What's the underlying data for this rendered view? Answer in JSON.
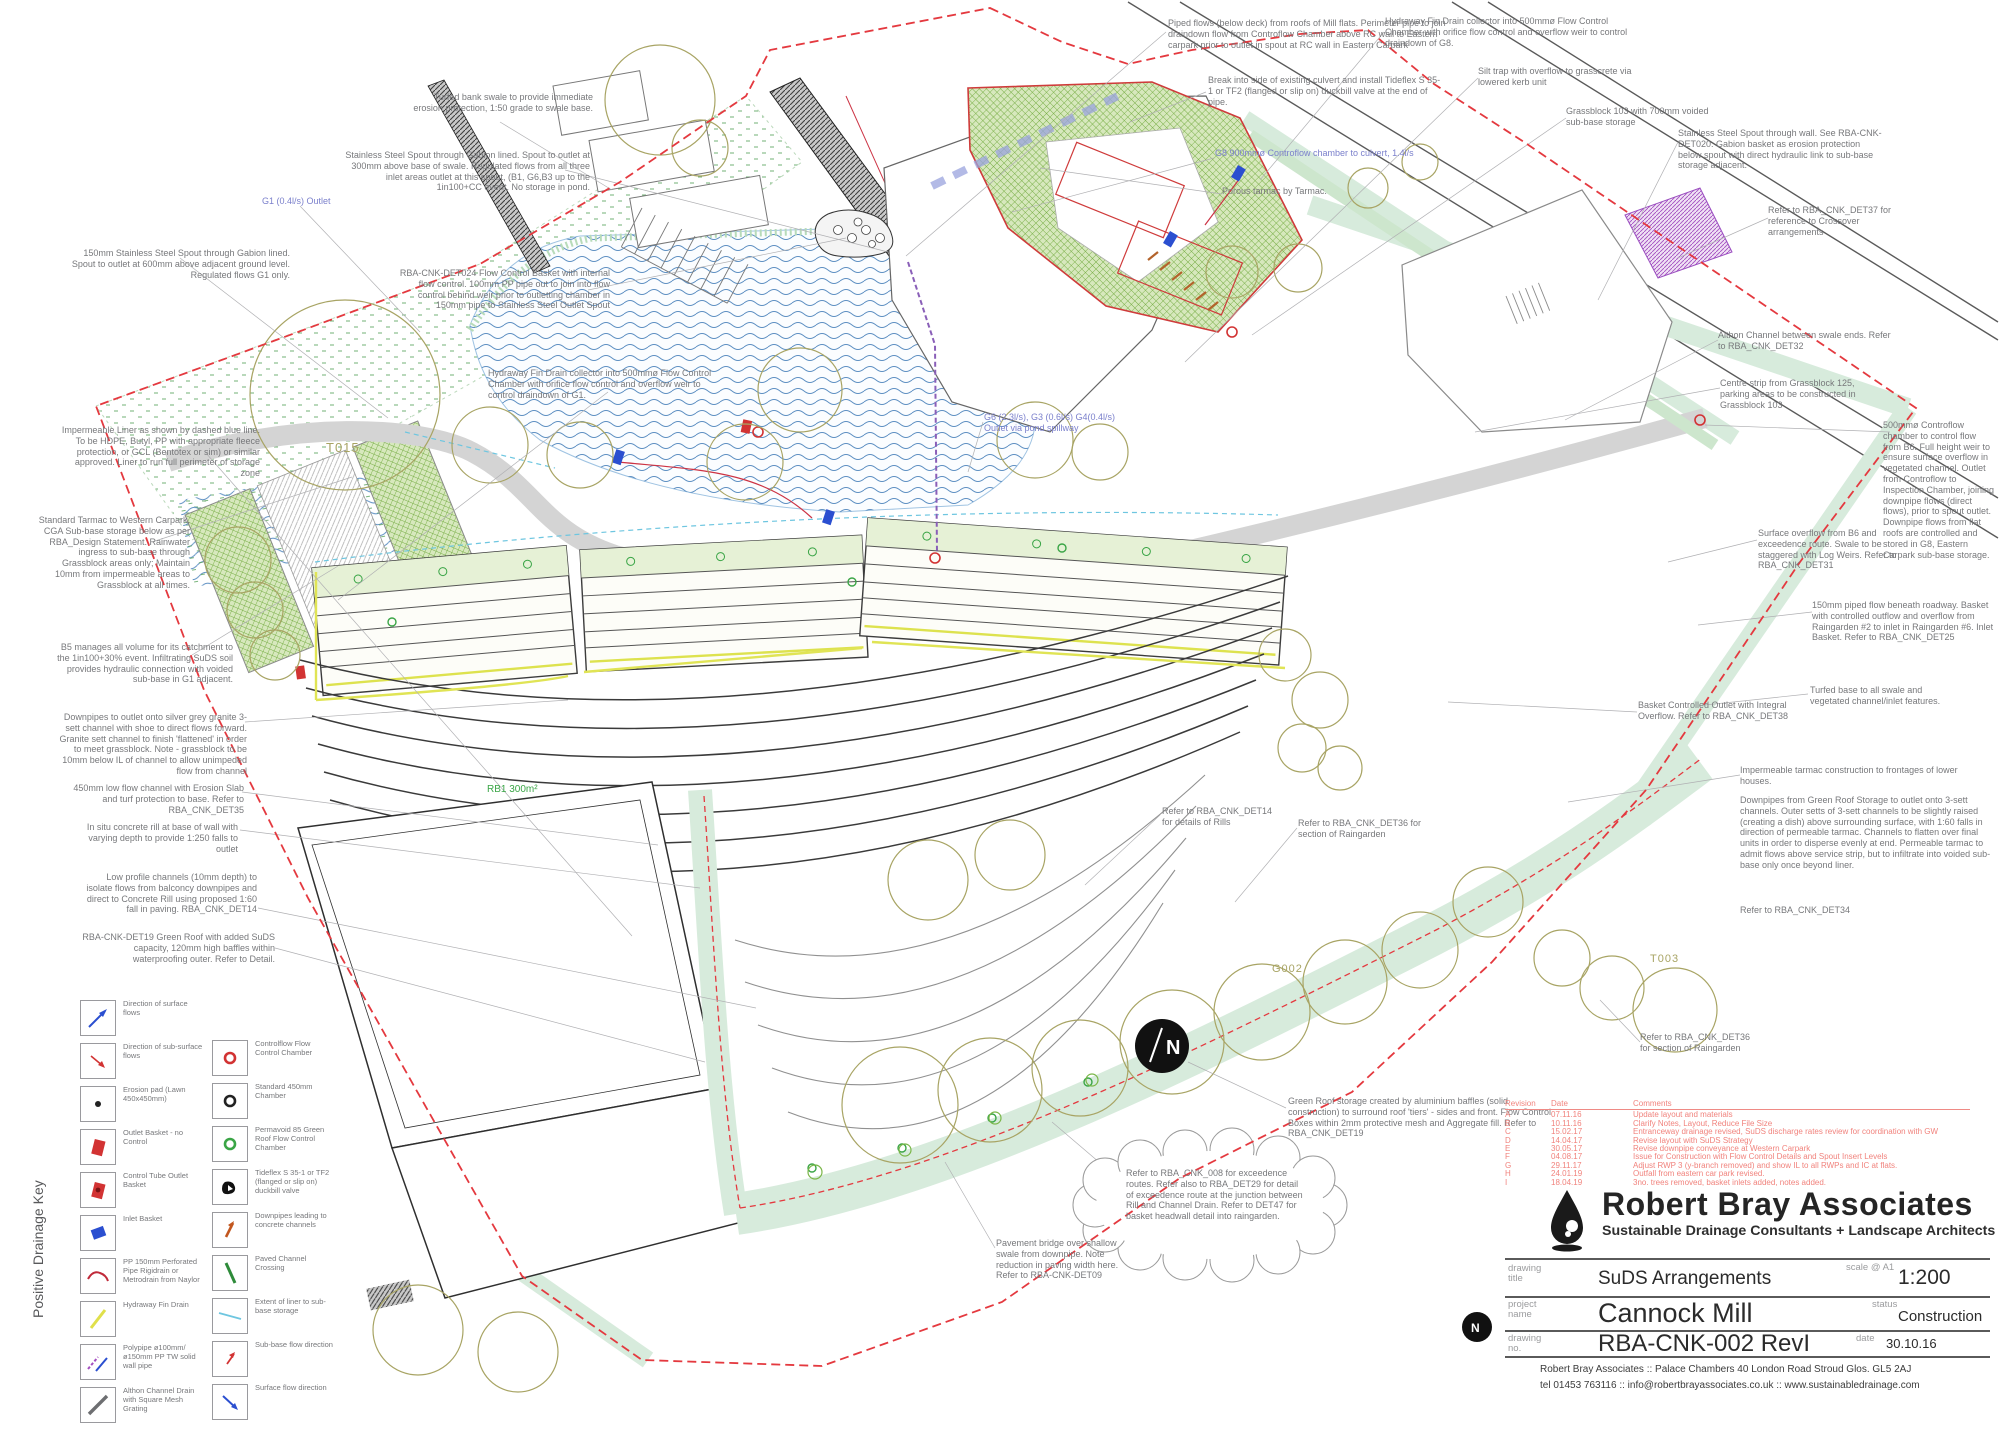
{
  "plan_labels": {
    "t015": "T015",
    "t003": "T003",
    "g002": "G002",
    "rb1": "RB1 300m²",
    "north": "N"
  },
  "annotations": [
    {
      "text": "150mm Stainless Steel Spout through Gabion lined. Spout to outlet at 600mm above adjacent ground level. Regulated flows G1 only."
    },
    {
      "text": "Impermeable Liner as shown by dashed blue line. To be HDPE, Butyl, PP with appropriate fleece protection, or GCL (Bentotex or sim) or similar approved. Liner to run full perimeter of storage zone"
    },
    {
      "text": "Standard Tarmac to Western Carpark, CGA Sub-base storage below as per RBA_Design Statement. Rainwater ingress to sub-base through Grassblock areas only; Maintain 10mm from impermeable areas to Grassblock at all times."
    },
    {
      "text": "B5 manages all volume for its catchment to the 1in100+30% event. Infiltrating SuDS soil provides hydraulic connection with voided sub-base in G1 adjacent."
    },
    {
      "text": "Downpipes to outlet onto silver grey granite 3-sett channel with shoe to direct flows forward. Granite sett channel to finish 'flattened' in order to meet grassblock. Note - grassblock to be 10mm below IL of channel to allow unimpeded flow from channel"
    },
    {
      "text": "450mm low flow channel with Erosion Slab and turf protection to base. Refer to RBA_CNK_DET35"
    },
    {
      "text": "In situ concrete rill at base of wall with varying depth to provide 1:250 falls to outlet"
    },
    {
      "text": "Low profile channels (10mm depth) to isolate flows from balconcy downpipes and direct to Concrete Rill using proposed 1:60 fall in paving. RBA_CNK_DET14"
    },
    {
      "text": "RBA-CNK-DET19 Green Roof with added SuDS capacity, 120mm high baffles within waterproofing outer. Refer to Detail."
    },
    {
      "text": "Turfed bank swale to provide immediate erosion protection, 1:50 grade to swale base."
    },
    {
      "text": "Stainless Steel Spout through Gabion lined. Spout to outlet at 300mm above base of swale. Regulated flows from all three inlet areas outlet at this spout, (B1, G6,B3 up to the 1in100+CC event. No storage in pond."
    },
    {
      "text": "RBA-CNK-DET024 Flow Control Basket with internal flow control. 100mm PP pipe out to join into flow control behind weir prior to outletting chamber in 150mm pipe to Stainless Steel Outlet Spout"
    },
    {
      "text": "Hydraway Fin Drain collector into 500mmø Flow Control Chamber with orifice flow control and overflow weir to control draindown of G1."
    },
    {
      "text": "Piped flows (below deck) from roofs of Mill flats. Perimeter pipe to join draindown flow from Controflow Chamber above RC wall to Eastern carpark prior to outlet in spout at RC wall in Eastern Carpark"
    },
    {
      "text": "Break into side of existing culvert and install Tideflex S 35-1 or TF2 (flanged or slip on) duckbill valve at the end of pipe."
    },
    {
      "text": "G8 900mmø Controflow chamber to culvert, 1.4l/s"
    },
    {
      "text": "Porous tarmac by Tarmac."
    },
    {
      "text": "Hydraway Fin Drain collector into 500mmø Flow Control Chamber with orifice flow control and overflow weir to control draindown of G8."
    },
    {
      "text": "Silt trap with overflow to grasscrete via lowered kerb unit"
    },
    {
      "text": "Grassblock 103 with 700mm voided sub-base storage"
    },
    {
      "text": "Stainless Steel Spout through wall. See RBA-CNK-DET020. Gabion basket as erosion protection below spout with direct hydraulic link to sub-base storage adjacent."
    },
    {
      "text": "Refer to RBA_CNK_DET37 for reference to Crossover arrangements"
    },
    {
      "text": "Althon Channel between swale ends. Refer to RBA_CNK_DET32"
    },
    {
      "text": "Centre strip from Grassblock 125, parking areas to be constructed in Grassblock 103"
    },
    {
      "text": "500mmø Controflow chamber to control flow from B6. Full height weir to ensure surface overflow in vegetated channel. Outlet from Controflow to Inspection Chamber, joining downpipe flows (direct flows), prior to spout outlet. Downpipe flows from flat roofs are controlled and stored in G8, Eastern Carpark sub-base storage."
    },
    {
      "text": "Surface overflow from B6 and exceedence route. Swale to be staggered with Log Weirs. Refer to RBA_CNK_DET31"
    },
    {
      "text": "150mm piped flow beneath roadway. Basket with controlled outflow and overflow from Raingarden #2 to inlet in Raingarden #6. Inlet Basket. Refer to RBA_CNK_DET25"
    },
    {
      "text": "Turfed base to all swale and vegetated channel/inlet features."
    },
    {
      "text": "Basket Controlled Outlet with Integral Overflow. Refer to RBA_CNK_DET38"
    },
    {
      "text": "Impermeable tarmac construction to frontages of lower houses."
    },
    {
      "text": "Downpipes from Green Roof Storage to outlet onto 3-sett channels. Outer setts of 3-sett channels to be slightly raised (creating a dish) above surrounding surface, with 1:60 falls in direction of permeable tarmac. Channels to flatten over final units in order to disperse evenly at end. Permeable tarmac to admit flows above service strip, but to infiltrate into voided sub-base only once beyond liner."
    },
    {
      "text": "Refer to RBA_CNK_DET34"
    },
    {
      "text": "Refer to RBA_CNK_DET14 for details of Rills"
    },
    {
      "text": "Refer to RBA_CNK_DET36 for section of Raingarden"
    },
    {
      "text": "Refer to RBA_CNK_DET36 for section of Raingarden"
    },
    {
      "text": "Refer to RBA_CNK_008 for exceedence routes. Refer also to RBA_DET29 for detail of exceedence route at the junction between Rill and Channel Drain. Refer to DET47 for basket headwall detail into raingarden."
    },
    {
      "text": "Green Roof storage created by aluminium baffles (solid construction) to surround roof 'tiers' - sides and front. Flow Control Boxes within 2mm protective mesh and Aggregate fill. Refer to RBA_CNK_DET19"
    },
    {
      "text": "Pavement bridge over shallow swale from downpipe. Note reduction in paving width here. Refer to RBA-CNK-DET09"
    },
    {
      "text": "G6 (2.3l/s), G3 (0.6l/s) G4(0.4l/s) Outlet via pond spillway"
    },
    {
      "text": "G1 (0.4l/s) Outlet"
    }
  ],
  "legend": {
    "title": "Positive Drainage Key",
    "left": [
      {
        "icon": "surface-flow-arrow",
        "label": "Direction of surface flows"
      },
      {
        "icon": "subsurface-flow-arrow",
        "label": "Direction of sub-surface flows"
      },
      {
        "icon": "erosion-pad",
        "label": "Erosion pad (Lawn 450x450mm)"
      },
      {
        "icon": "outlet-basket",
        "label": "Outlet Basket - no Control"
      },
      {
        "icon": "control-tube-outlet-basket",
        "label": "Control Tube Outlet Basket"
      },
      {
        "icon": "inlet-basket",
        "label": "Inlet Basket"
      },
      {
        "icon": "perforated-pipe",
        "label": "PP 150mm Perforated Pipe Rigidrain or Metrodrain from Naylor"
      },
      {
        "icon": "hydraway-fin-drain",
        "label": "Hydraway Fin Drain"
      },
      {
        "icon": "polypipe",
        "label": "Polypipe ø100mm/ ø150mm PP TW solid wall pipe"
      },
      {
        "icon": "althon-channel-drain",
        "label": "Althon Channel Drain with Square Mesh Grating"
      }
    ],
    "right": [
      {
        "icon": "controlflow-chamber",
        "label": "Controlflow Flow Control Chamber"
      },
      {
        "icon": "standard-chamber",
        "label": "Standard 450mm Chamber"
      },
      {
        "icon": "permavoid-chamber",
        "label": "Permavoid 85 Green Roof Flow Control Chamber"
      },
      {
        "icon": "tideflex-valve",
        "label": "Tideflex S 35-1 or TF2 (flanged or slip on) duckbill valve"
      },
      {
        "icon": "downpipe-to-channel",
        "label": "Downpipes leading to concrete channels"
      },
      {
        "icon": "paved-channel-crossing",
        "label": "Paved Channel Crossing"
      },
      {
        "icon": "liner-extent",
        "label": "Extent of liner to sub-base storage"
      },
      {
        "icon": "subbase-flow-arrow",
        "label": "Sub-base flow direction"
      },
      {
        "icon": "surface-flow-direction",
        "label": "Surface flow direction"
      }
    ]
  },
  "title_block": {
    "company": "Robert Bray Associates",
    "tagline": "Sustainable Drainage Consultants + Landscape Architects",
    "drawing_title_label": "drawing title",
    "drawing_title": "SuDS Arrangements",
    "scale_label": "scale @ A1",
    "scale": "1:200",
    "project_label": "project name",
    "project": "Cannock Mill",
    "status_label": "status",
    "status": "Construction",
    "drawing_no_label": "drawing no.",
    "drawing_no": "RBA-CNK-002 RevI",
    "date_label": "date",
    "date": "30.10.16",
    "address": "Robert Bray Associates  ::  Palace Chambers   40 London Road   Stroud   Glos.   GL5 2AJ",
    "contact": "tel 01453 763116   ::   info@robertbrayassociates.co.uk  ::  www.sustainabledrainage.com",
    "rev_head": {
      "rev": "Revision",
      "date": "Date",
      "comment": "Comments"
    },
    "revisions": [
      {
        "rev": "A",
        "date": "07.11.16",
        "comment": "Update layout and materials"
      },
      {
        "rev": "B",
        "date": "10.11.16",
        "comment": "Clarify Notes, Layout, Reduce File Size"
      },
      {
        "rev": "C",
        "date": "15.02.17",
        "comment": "Entranceway drainage revised, SuDS discharge rates review for coordination with GW"
      },
      {
        "rev": "D",
        "date": "14.04.17",
        "comment": "Revise layout with SuDS Strategy"
      },
      {
        "rev": "E",
        "date": "30.05.17",
        "comment": "Revise downpipe conveyance at Western Carpark"
      },
      {
        "rev": "F",
        "date": "04.08.17",
        "comment": "Issue for Construction with Flow Control Details and Spout Insert Levels"
      },
      {
        "rev": "G",
        "date": "29.11.17",
        "comment": "Adjust RWP 3 (y-branch removed) and show IL to all RWPs and IC at flats."
      },
      {
        "rev": "H",
        "date": "24.01.19",
        "comment": "Outfall from eastern car park revised."
      },
      {
        "rev": "I",
        "date": "18.04.19",
        "comment": "3no. trees removed, basket inlets added, notes added."
      }
    ]
  }
}
